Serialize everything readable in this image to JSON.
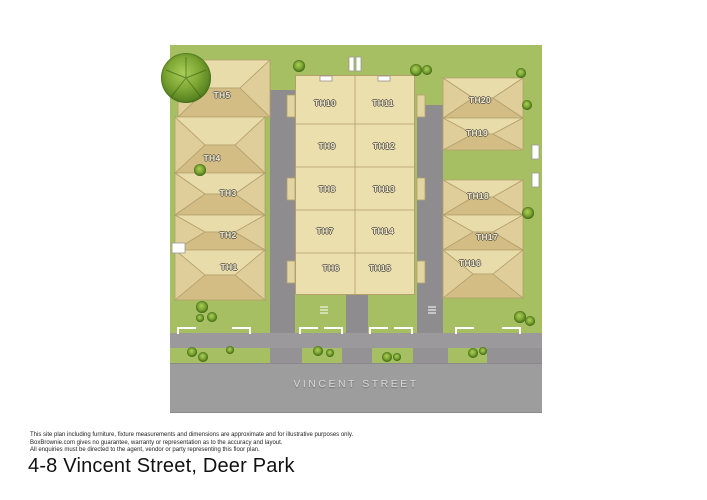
{
  "page": {
    "title": "4-8 Vincent Street, Deer Park",
    "disclaimer_lines": [
      "This site plan including furniture, fixture measurements and dimensions are approximate and for illustrative purposes only.",
      "BoxBrownie.com gives no guarantee, warranty or representation as to the accuracy and layout.",
      "All enquiries must be directed to the agent, vendor or party representing this floor plan."
    ]
  },
  "site_plan": {
    "street_label": "VINCENT STREET",
    "left_row_units": [
      "TH5",
      "TH4",
      "TH3",
      "TH2",
      "TH1"
    ],
    "middle_left_units": [
      "TH10",
      "TH9",
      "TH8",
      "TH7",
      "TH6"
    ],
    "middle_right_units": [
      "TH11",
      "TH12",
      "TH13",
      "TH14",
      "TH15"
    ],
    "right_row_units": [
      "TH20",
      "TH19",
      "TH18",
      "TH17",
      "TH16"
    ]
  },
  "colors": {
    "grass": "#a6bf62",
    "tree_dark": "#3f6a16",
    "tree_light": "#aace58",
    "building": "#ecdfae",
    "roof_shade": "#d3bd85",
    "outline": "#b3a06c",
    "driveway": "#8e8c8e",
    "road": "#9d9d9d",
    "unit_label": "#eee6cd"
  }
}
